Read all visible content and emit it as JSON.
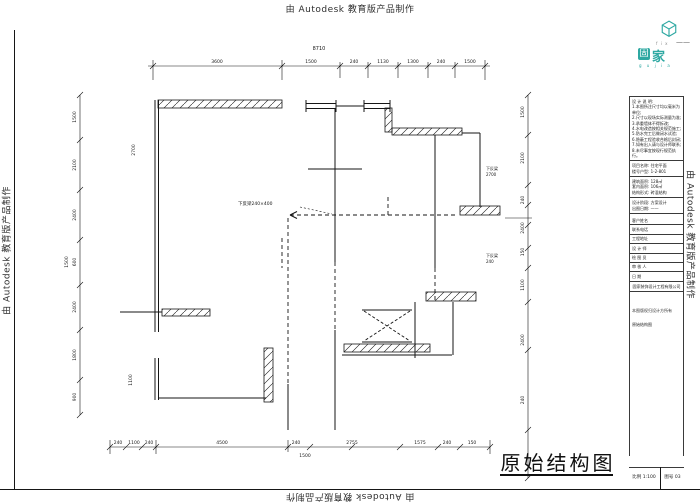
{
  "watermark": {
    "text": "由 Autodesk 教育版产品制作"
  },
  "logo": {
    "mini": "f i x",
    "dash": "——",
    "brand_boxed": "固",
    "brand_plain": "家",
    "subtext": "g u j i a",
    "teal": "#2ea8a2"
  },
  "drawing_title": {
    "text": "原始结构图",
    "scale_stamp": "比例 1:100",
    "sheet_stamp": "图号 03"
  },
  "title_block": {
    "notes": [
      "设 计 说 明:",
      "1.本图所注尺寸均以毫米为单位;",
      "2.尺寸以现场实际测量为准;",
      "3.承重墙体不得拆改;",
      "4.水电改造按相关规范施工;",
      "5.防水完工后做闭水试验;",
      "6.隐蔽工程验收合格后封闭;",
      "7.如有出入请与设计师联系;",
      "8.未尽事宜按现行规范执行。"
    ],
    "group1": [
      "项目名称: 住宅平面",
      "楼号户型: 1-2-801"
    ],
    "group2": [
      "建筑面积: 128㎡",
      "套内面积: 106㎡",
      "结构形式: 砖混结构"
    ],
    "group3": [
      "设计阶段: 方案设计",
      "出图日期: ——"
    ],
    "fields": [
      {
        "label": "客户姓名",
        "value": ""
      },
      {
        "label": "联系电话",
        "value": ""
      },
      {
        "label": "工程地址",
        "value": ""
      },
      {
        "label": "设 计 师",
        "value": ""
      },
      {
        "label": "绘 图 员",
        "value": ""
      },
      {
        "label": "审 核 人",
        "value": ""
      },
      {
        "label": "日 期",
        "value": ""
      }
    ],
    "company": "固家装饰设计工程有限公司",
    "footnote": "本图版权归设计方所有",
    "sheet_name": "原始结构图"
  },
  "dims": {
    "top": {
      "total": "8710",
      "labels": [
        "3600",
        "1500",
        "240",
        "1130",
        "1300",
        "240",
        "1500"
      ]
    },
    "left": {
      "labels": [
        "1500",
        "2100",
        "2400",
        "600",
        "2400",
        "1800",
        "900"
      ],
      "extra": "1500"
    },
    "left_inner": [
      "2700",
      "1100"
    ],
    "right": {
      "labels": [
        "1500",
        "2100",
        "240",
        "2400",
        "150",
        "1100",
        "2400",
        "240"
      ]
    },
    "bottom": {
      "labels": [
        "240",
        "1100",
        "240",
        "4500",
        "240",
        "2755",
        "1575",
        "240",
        "150"
      ],
      "sub": "1500"
    },
    "annotations": {
      "beam": "下反梁240×400",
      "r1a": "下反梁",
      "r1b": "2700",
      "r2a": "下反梁",
      "r2b": "240"
    }
  },
  "colors": {
    "teal": "#2ea8a2",
    "line": "#161616"
  }
}
